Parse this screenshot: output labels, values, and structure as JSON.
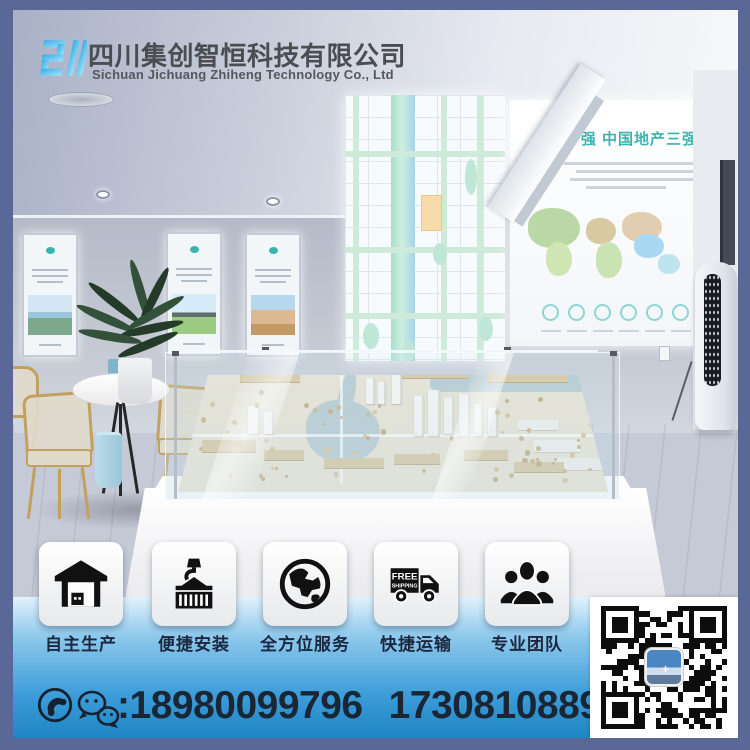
{
  "header": {
    "company_name_cn": "四川集创智恒科技有限公司",
    "company_name_en": "Sichuan Jichuang Zhiheng Technology Co., Ltd"
  },
  "showroom": {
    "wall_panel_headline": "强  中国地产三强"
  },
  "features": [
    {
      "label": "自主生产",
      "icon": "warehouse-icon"
    },
    {
      "label": "便捷安装",
      "icon": "container-crane-icon"
    },
    {
      "label": "全方位服务",
      "icon": "globe-icon"
    },
    {
      "label": "快捷运输",
      "icon": "shipping-truck-icon",
      "truck_line1": "FREE",
      "truck_line2": "SHIPPING"
    },
    {
      "label": "专业团队",
      "icon": "team-icon"
    }
  ],
  "contact": {
    "colon": ":",
    "phone_primary": "18980099796",
    "phone_secondary": "17308108896"
  },
  "colors": {
    "frame": "#5a6897",
    "band_top": "#e3f2fc",
    "band_bottom": "#1e85c4",
    "accent_teal": "#3ab4b0",
    "logo_blue": "#45bdef"
  }
}
